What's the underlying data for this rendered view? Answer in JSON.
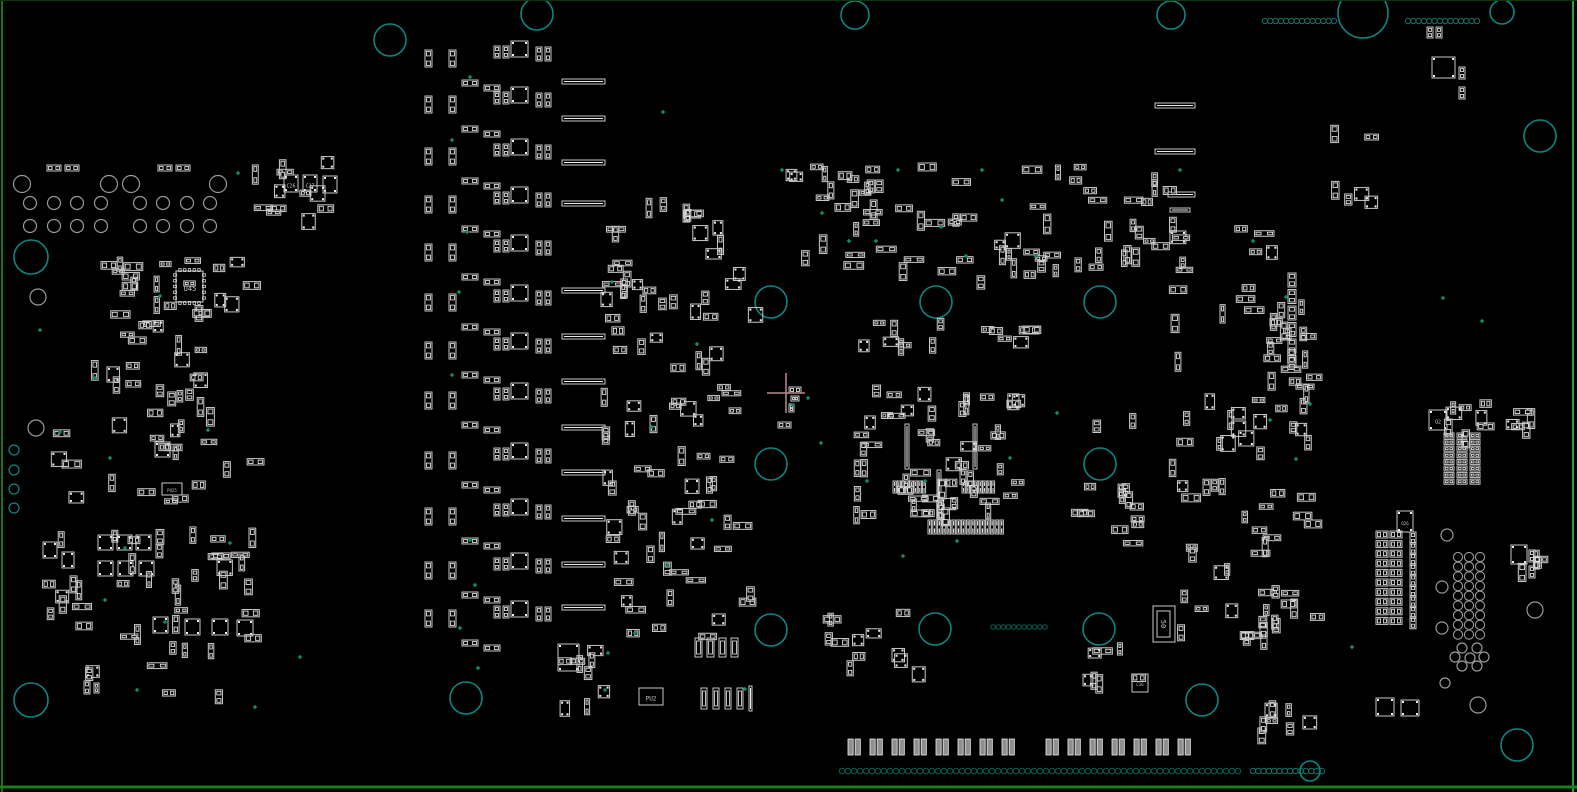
{
  "canvas": {
    "width": 1577,
    "height": 792,
    "background": "#000000"
  },
  "colors": {
    "outline": "#c9c9c9",
    "pad": "#ededed",
    "pad_fill": "#111111",
    "hole_gray": "#9a9a9a",
    "hole_teal": "#0d8583",
    "dot_teal": "#0e7468",
    "dot_dark": "#0a5f50",
    "mark_green": "#0f8a6e",
    "crosshair": "#ba8a8f",
    "label": "#c9c9c9",
    "fill_pad2": "#8f8f8f",
    "border_left": "#1e6f1e",
    "border_right": "#2da12d",
    "border_bottom": "#1c7f1c",
    "border_top": "#0d330d"
  },
  "crosshair": {
    "x": 786,
    "y": 393,
    "arm_h": 19,
    "arm_v": 20
  },
  "labels": [
    {
      "text": "U45",
      "x": 190,
      "y": 289,
      "size": 7,
      "rot": 0
    },
    {
      "text": "C26",
      "x": 291,
      "y": 186,
      "size": 5,
      "rot": 0
    },
    {
      "text": "C27",
      "x": 310,
      "y": 186,
      "size": 5,
      "rot": 0
    },
    {
      "text": "PU2",
      "x": 651,
      "y": 699,
      "size": 6,
      "rot": 0
    },
    {
      "text": "PU25",
      "x": 172,
      "y": 491,
      "size": 4,
      "rot": 0
    },
    {
      "text": "50",
      "x": 1163,
      "y": 624,
      "size": 7,
      "rot": 90
    },
    {
      "text": "C16",
      "x": 1140,
      "y": 685,
      "size": 4,
      "rot": 0
    },
    {
      "text": "Q2",
      "x": 1438,
      "y": 422,
      "size": 5,
      "rot": 0
    },
    {
      "text": "Q26",
      "x": 1405,
      "y": 524,
      "size": 4,
      "rot": 0
    }
  ],
  "holes_teal": [
    [
      390,
      40,
      16
    ],
    [
      537,
      14,
      16
    ],
    [
      855,
      15,
      14
    ],
    [
      1171,
      15,
      14
    ],
    [
      1363,
      13,
      25
    ],
    [
      1502,
      12,
      12
    ],
    [
      1540,
      136,
      16
    ],
    [
      31,
      257,
      17
    ],
    [
      771,
      302,
      16
    ],
    [
      936,
      302,
      16
    ],
    [
      1100,
      302,
      16
    ],
    [
      771,
      464,
      16
    ],
    [
      1100,
      464,
      16
    ],
    [
      771,
      630,
      16
    ],
    [
      935,
      629,
      16
    ],
    [
      1099,
      629,
      16
    ],
    [
      466,
      698,
      16
    ],
    [
      31,
      700,
      17
    ],
    [
      1202,
      700,
      16
    ],
    [
      1517,
      745,
      16
    ],
    [
      1310,
      771,
      10
    ],
    [
      14,
      450,
      5
    ],
    [
      14,
      470,
      5
    ],
    [
      14,
      489,
      5
    ],
    [
      14,
      508,
      5
    ]
  ],
  "holes_gray": [
    [
      22,
      184,
      8.5
    ],
    [
      109,
      184,
      8.5
    ],
    [
      131,
      184,
      8.5
    ],
    [
      218,
      184,
      8.5
    ],
    [
      30,
      203,
      6.5
    ],
    [
      54,
      203,
      6.5
    ],
    [
      77,
      203,
      6.5
    ],
    [
      101,
      203,
      6.5
    ],
    [
      140,
      203,
      6.5
    ],
    [
      163,
      203,
      6.5
    ],
    [
      187,
      203,
      6.5
    ],
    [
      210,
      203,
      6.5
    ],
    [
      30,
      226,
      6.5
    ],
    [
      54,
      226,
      6.5
    ],
    [
      77,
      226,
      6.5
    ],
    [
      101,
      226,
      6.5
    ],
    [
      140,
      226,
      6.5
    ],
    [
      163,
      226,
      6.5
    ],
    [
      187,
      226,
      6.5
    ],
    [
      210,
      226,
      6.5
    ],
    [
      38,
      297,
      8
    ],
    [
      36,
      428,
      8
    ],
    [
      1447,
      535,
      6
    ],
    [
      1442,
      587,
      6
    ],
    [
      1442,
      628,
      6
    ],
    [
      1445,
      683,
      5
    ],
    [
      1478,
      705,
      8
    ],
    [
      1535,
      610,
      8
    ],
    [
      1462,
      648,
      5
    ],
    [
      1477,
      648,
      5
    ],
    [
      1455,
      657,
      5
    ],
    [
      1470,
      658,
      5
    ],
    [
      1484,
      657,
      5
    ],
    [
      1462,
      666,
      5
    ],
    [
      1477,
      666,
      5
    ]
  ],
  "hole_grid": {
    "x": 1458,
    "y": 557,
    "cols": 3,
    "rows": 9,
    "dx": 11,
    "dy": 9.7,
    "r": 4.6
  },
  "dot_rows": [
    {
      "x": 1265,
      "y": 21,
      "n": 14,
      "sp": 5.3,
      "r": 2.7,
      "c": "teal"
    },
    {
      "x": 1408,
      "y": 21,
      "n": 14,
      "sp": 5.3,
      "r": 2.7,
      "c": "teal"
    },
    {
      "x": 842,
      "y": 771,
      "n": 67,
      "sp": 6.0,
      "r": 2.8,
      "c": "dark"
    },
    {
      "x": 1253,
      "y": 771,
      "n": 14,
      "sp": 5.3,
      "r": 2.8,
      "c": "teal"
    },
    {
      "x": 993,
      "y": 627,
      "n": 11,
      "sp": 5.2,
      "r": 2.3,
      "c": "dark"
    }
  ],
  "green_dots": [
    [
      238,
      173
    ],
    [
      160,
      296
    ],
    [
      40,
      330
    ],
    [
      95,
      378
    ],
    [
      60,
      432
    ],
    [
      110,
      458
    ],
    [
      208,
      430
    ],
    [
      230,
      543
    ],
    [
      125,
      548
    ],
    [
      105,
      600
    ],
    [
      165,
      622
    ],
    [
      137,
      690
    ],
    [
      300,
      657
    ],
    [
      255,
      707
    ],
    [
      470,
      77
    ],
    [
      452,
      140
    ],
    [
      467,
      232
    ],
    [
      459,
      292
    ],
    [
      452,
      375
    ],
    [
      470,
      540
    ],
    [
      475,
      585
    ],
    [
      460,
      628
    ],
    [
      478,
      668
    ],
    [
      663,
      112
    ],
    [
      612,
      282
    ],
    [
      697,
      344
    ],
    [
      652,
      427
    ],
    [
      712,
      520
    ],
    [
      667,
      565
    ],
    [
      608,
      653
    ],
    [
      635,
      633
    ],
    [
      793,
      405
    ],
    [
      808,
      398
    ],
    [
      821,
      443
    ],
    [
      867,
      481
    ],
    [
      925,
      481
    ],
    [
      1010,
      458
    ],
    [
      903,
      556
    ],
    [
      957,
      541
    ],
    [
      782,
      170
    ],
    [
      898,
      170
    ],
    [
      941,
      227
    ],
    [
      982,
      170
    ],
    [
      1002,
      200
    ],
    [
      966,
      256
    ],
    [
      1036,
      256
    ],
    [
      822,
      213
    ],
    [
      849,
      241
    ],
    [
      876,
      241
    ],
    [
      1180,
      170
    ],
    [
      1253,
      241
    ],
    [
      1286,
      297
    ],
    [
      1310,
      404
    ],
    [
      1270,
      420
    ],
    [
      1296,
      459
    ],
    [
      1352,
      647
    ],
    [
      1443,
      298
    ],
    [
      1482,
      321
    ],
    [
      745,
      689
    ],
    [
      605,
      690
    ],
    [
      1057,
      413
    ]
  ],
  "units": {
    "ys": [
      44,
      90,
      142,
      190,
      238,
      288,
      336,
      386,
      446,
      502,
      556,
      604
    ],
    "parts": [
      [
        425,
        6,
        7,
        17,
        "v"
      ],
      [
        449,
        6,
        7,
        17,
        "v"
      ],
      [
        462,
        36,
        16,
        6,
        "h"
      ],
      [
        484,
        41,
        16,
        6,
        "h"
      ],
      [
        494,
        2,
        6,
        12,
        "v"
      ],
      [
        503,
        2,
        6,
        12,
        "v"
      ],
      [
        511,
        -3,
        17,
        16,
        "s"
      ],
      [
        536,
        3,
        6,
        14,
        "v"
      ],
      [
        545,
        3,
        6,
        14,
        "v"
      ]
    ]
  },
  "bars": {
    "x": 562,
    "w": 43,
    "h": 5,
    "ys": [
      79,
      116,
      160,
      201,
      288,
      334,
      379,
      425,
      470,
      516,
      562,
      605
    ]
  },
  "grids": [
    {
      "x": 1444,
      "y": 433,
      "cols": 3,
      "rows": 8,
      "dx": 13,
      "dy": 6.6,
      "w": 10,
      "h": 5,
      "kind": "h",
      "skip": []
    },
    {
      "x": 1376,
      "y": 531,
      "cols": 2,
      "rows": 10,
      "dx": 14,
      "dy": 9.6,
      "w": 12,
      "h": 7,
      "kind": "h",
      "skip": []
    },
    {
      "x": 1410,
      "y": 532,
      "cols": 1,
      "rows": 9,
      "dx": 0,
      "dy": 10.6,
      "w": 6,
      "h": 12,
      "kind": "v",
      "skip": []
    },
    {
      "x": 848,
      "y": 739,
      "cols": 16,
      "rows": 1,
      "dx": 22,
      "dy": 0,
      "w": 13,
      "h": 16,
      "kind": "p2",
      "skip": [
        8
      ]
    },
    {
      "x": 928,
      "y": 520,
      "cols": 16,
      "rows": 1,
      "dx": 4.8,
      "dy": 0,
      "w": 3.4,
      "h": 14,
      "kind": "v",
      "skip": []
    },
    {
      "x": 893,
      "y": 481,
      "cols": 8,
      "rows": 1,
      "dx": 4.2,
      "dy": 0,
      "w": 3.2,
      "h": 12,
      "kind": "v",
      "skip": []
    },
    {
      "x": 962,
      "y": 481,
      "cols": 8,
      "rows": 1,
      "dx": 4.2,
      "dy": 0,
      "w": 3.2,
      "h": 12,
      "kind": "v",
      "skip": []
    },
    {
      "x": 1288,
      "y": 273,
      "cols": 1,
      "rows": 6,
      "dx": 0,
      "dy": 16.5,
      "w": 8,
      "h": 14,
      "kind": "v",
      "skip": []
    }
  ],
  "explicit": [
    [
      47,
      165,
      14,
      6,
      "h"
    ],
    [
      65,
      165,
      14,
      6,
      "h"
    ],
    [
      158,
      165,
      14,
      6,
      "h"
    ],
    [
      176,
      165,
      14,
      6,
      "h"
    ],
    [
      284,
      175,
      14,
      17,
      "s"
    ],
    [
      303,
      175,
      14,
      17,
      "s"
    ],
    [
      323,
      176,
      14,
      17,
      "s"
    ],
    [
      176,
      271,
      27,
      31,
      "q"
    ],
    [
      98,
      535,
      15,
      15,
      "s"
    ],
    [
      117,
      535,
      15,
      15,
      "s"
    ],
    [
      136,
      535,
      15,
      15,
      "s"
    ],
    [
      98,
      561,
      15,
      15,
      "s"
    ],
    [
      118,
      561,
      15,
      15,
      "s"
    ],
    [
      139,
      561,
      15,
      15,
      "s"
    ],
    [
      153,
      617,
      15,
      16,
      "s"
    ],
    [
      185,
      619,
      15,
      16,
      "s"
    ],
    [
      212,
      619,
      16,
      16,
      "s"
    ],
    [
      237,
      620,
      16,
      16,
      "s"
    ],
    [
      43,
      542,
      14,
      16,
      "s"
    ],
    [
      62,
      552,
      12,
      16,
      "s"
    ],
    [
      155,
      442,
      15,
      15,
      "s"
    ],
    [
      162,
      483,
      20,
      12,
      "box"
    ],
    [
      789,
      387,
      12,
      6,
      "h"
    ],
    [
      791,
      396,
      8,
      5,
      "h"
    ],
    [
      789,
      404,
      5,
      8,
      "v"
    ],
    [
      778,
      422,
      13,
      6,
      "h"
    ],
    [
      905,
      424,
      4,
      45,
      "vb"
    ],
    [
      973,
      424,
      4,
      45,
      "vb"
    ],
    [
      937,
      470,
      4,
      46,
      "vb"
    ],
    [
      1155,
      103,
      40,
      5,
      "b"
    ],
    [
      1155,
      149,
      40,
      5,
      "b"
    ],
    [
      1168,
      192,
      27,
      5,
      "b"
    ],
    [
      1170,
      208,
      20,
      4,
      "b"
    ],
    [
      695,
      638,
      7,
      19,
      "conn"
    ],
    [
      707,
      638,
      7,
      19,
      "conn"
    ],
    [
      719,
      638,
      7,
      19,
      "conn"
    ],
    [
      731,
      638,
      7,
      19,
      "conn"
    ],
    [
      701,
      688,
      6,
      21,
      "conn"
    ],
    [
      713,
      688,
      6,
      21,
      "conn"
    ],
    [
      725,
      688,
      6,
      21,
      "conn"
    ],
    [
      737,
      688,
      6,
      21,
      "conn"
    ],
    [
      749,
      686,
      3,
      25,
      "vb"
    ],
    [
      558,
      644,
      21,
      27,
      "s"
    ],
    [
      639,
      688,
      24,
      17,
      "box"
    ],
    [
      1153,
      606,
      22,
      36,
      "box"
    ],
    [
      1157,
      611,
      13,
      26,
      "box"
    ],
    [
      1132,
      674,
      16,
      18,
      "box"
    ],
    [
      1429,
      410,
      18,
      20,
      "s"
    ],
    [
      1397,
      511,
      16,
      21,
      "s"
    ],
    [
      1376,
      698,
      18,
      18,
      "s"
    ],
    [
      1401,
      700,
      18,
      16,
      "s"
    ],
    [
      1511,
      545,
      16,
      19,
      "s"
    ],
    [
      1529,
      550,
      6,
      12,
      "v"
    ],
    [
      1529,
      566,
      6,
      12,
      "v"
    ],
    [
      1427,
      27,
      6,
      11,
      "v"
    ],
    [
      1436,
      27,
      6,
      11,
      "v"
    ],
    [
      1432,
      57,
      23,
      21,
      "s"
    ],
    [
      1459,
      67,
      6,
      12,
      "v"
    ],
    [
      1459,
      87,
      6,
      12,
      "v"
    ],
    [
      84,
      681,
      6,
      13,
      "v"
    ],
    [
      94,
      683,
      5,
      10,
      "v"
    ]
  ],
  "clusters": [
    [
      100,
      255,
      148,
      72,
      26
    ],
    [
      85,
      330,
      125,
      95,
      22
    ],
    [
      35,
      425,
      215,
      185,
      46
    ],
    [
      75,
      612,
      170,
      78,
      13
    ],
    [
      252,
      152,
      80,
      72,
      12
    ],
    [
      605,
      188,
      130,
      45,
      10
    ],
    [
      600,
      235,
      150,
      195,
      42
    ],
    [
      598,
      432,
      150,
      205,
      40
    ],
    [
      785,
      160,
      148,
      118,
      30
    ],
    [
      938,
      162,
      138,
      115,
      25
    ],
    [
      1082,
      170,
      95,
      95,
      14
    ],
    [
      1125,
      215,
      60,
      55,
      8
    ],
    [
      852,
      385,
      165,
      130,
      55
    ],
    [
      858,
      315,
      90,
      30,
      8
    ],
    [
      965,
      318,
      60,
      28,
      6
    ],
    [
      1062,
      385,
      70,
      170,
      14
    ],
    [
      1162,
      282,
      150,
      180,
      36
    ],
    [
      1162,
      468,
      150,
      165,
      33
    ],
    [
      822,
      608,
      95,
      60,
      12
    ],
    [
      1075,
      640,
      60,
      45,
      7
    ],
    [
      1238,
      598,
      30,
      45,
      5
    ],
    [
      1250,
      700,
      60,
      28,
      8
    ],
    [
      1420,
      398,
      60,
      34,
      8
    ],
    [
      1496,
      402,
      42,
      26,
      5
    ],
    [
      1500,
      536,
      40,
      30,
      4
    ],
    [
      548,
      638,
      85,
      70,
      9
    ],
    [
      1325,
      115,
      60,
      100,
      6
    ],
    [
      1230,
      225,
      40,
      30,
      4
    ],
    [
      1262,
      270,
      45,
      110,
      8
    ]
  ]
}
